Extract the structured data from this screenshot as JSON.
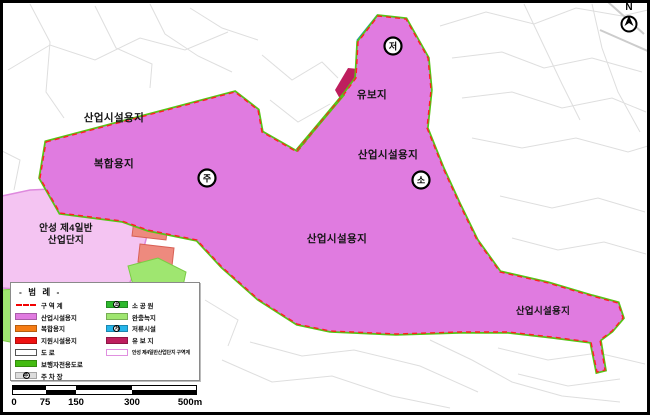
{
  "colors": {
    "industrial_violet": "#E07BE0",
    "existing_complex_pink": "#F4C4F2",
    "mixed_use_orange": "#F57C14",
    "support_red": "#EE1111",
    "reserved_crimson": "#BE1E5E",
    "retention_cyan": "#25B5EA",
    "pedestrian_green": "#44BB11",
    "park_green": "#2DB82D",
    "buffer_light_green": "#9FE670",
    "parking_gray": "#C9C9C9",
    "boundary_red": "#FF2020",
    "road_white": "#FFFFFF"
  },
  "map": {
    "north_label": "N",
    "labels": {
      "industrial_nw": "산업시설용지",
      "mixed_use": "복합용지",
      "reserved": "유보지",
      "industrial_center": "산업시설용지",
      "industrial_south": "산업시설용지",
      "industrial_east": "산업시설용지",
      "anseong_line1": "안성 제4일반",
      "anseong_line2": "산업단지"
    },
    "symbols": {
      "parking": "주",
      "park": "소",
      "retention": "저"
    }
  },
  "legend": {
    "title": "- 범 례 -",
    "left": [
      {
        "label": "구 역 계",
        "type": "boundary",
        "color": "#FF2020"
      },
      {
        "label": "산업시설용지",
        "type": "fill",
        "color": "#E07BE0"
      },
      {
        "label": "복합용지",
        "type": "fill",
        "color": "#F57C14"
      },
      {
        "label": "지원시설용지",
        "type": "fill",
        "color": "#EE1111"
      },
      {
        "label": "도  로",
        "type": "road",
        "color": "#FFFFFF"
      },
      {
        "label": "보행자전용도로",
        "type": "fill",
        "color": "#44BB11"
      },
      {
        "label": "주 차 장",
        "type": "symbol",
        "symbol": "주",
        "color": "#DDDDDD"
      }
    ],
    "right": [
      {
        "label": "소 공 원",
        "type": "symbol",
        "symbol": "소",
        "color": "#2DB82D"
      },
      {
        "label": "완충녹지",
        "type": "fill",
        "color": "#9FE670"
      },
      {
        "label": "저류시설",
        "type": "symbol",
        "symbol": "저",
        "color": "#25B5EA"
      },
      {
        "label": "유 보 지",
        "type": "fill",
        "color": "#BE1E5E"
      },
      {
        "label": "안성 제4일반산업단지 구역계",
        "type": "outline",
        "color": "#E090E0"
      }
    ]
  },
  "scalebar": {
    "labels": [
      "0",
      "75",
      "150",
      "300",
      "500m"
    ]
  }
}
